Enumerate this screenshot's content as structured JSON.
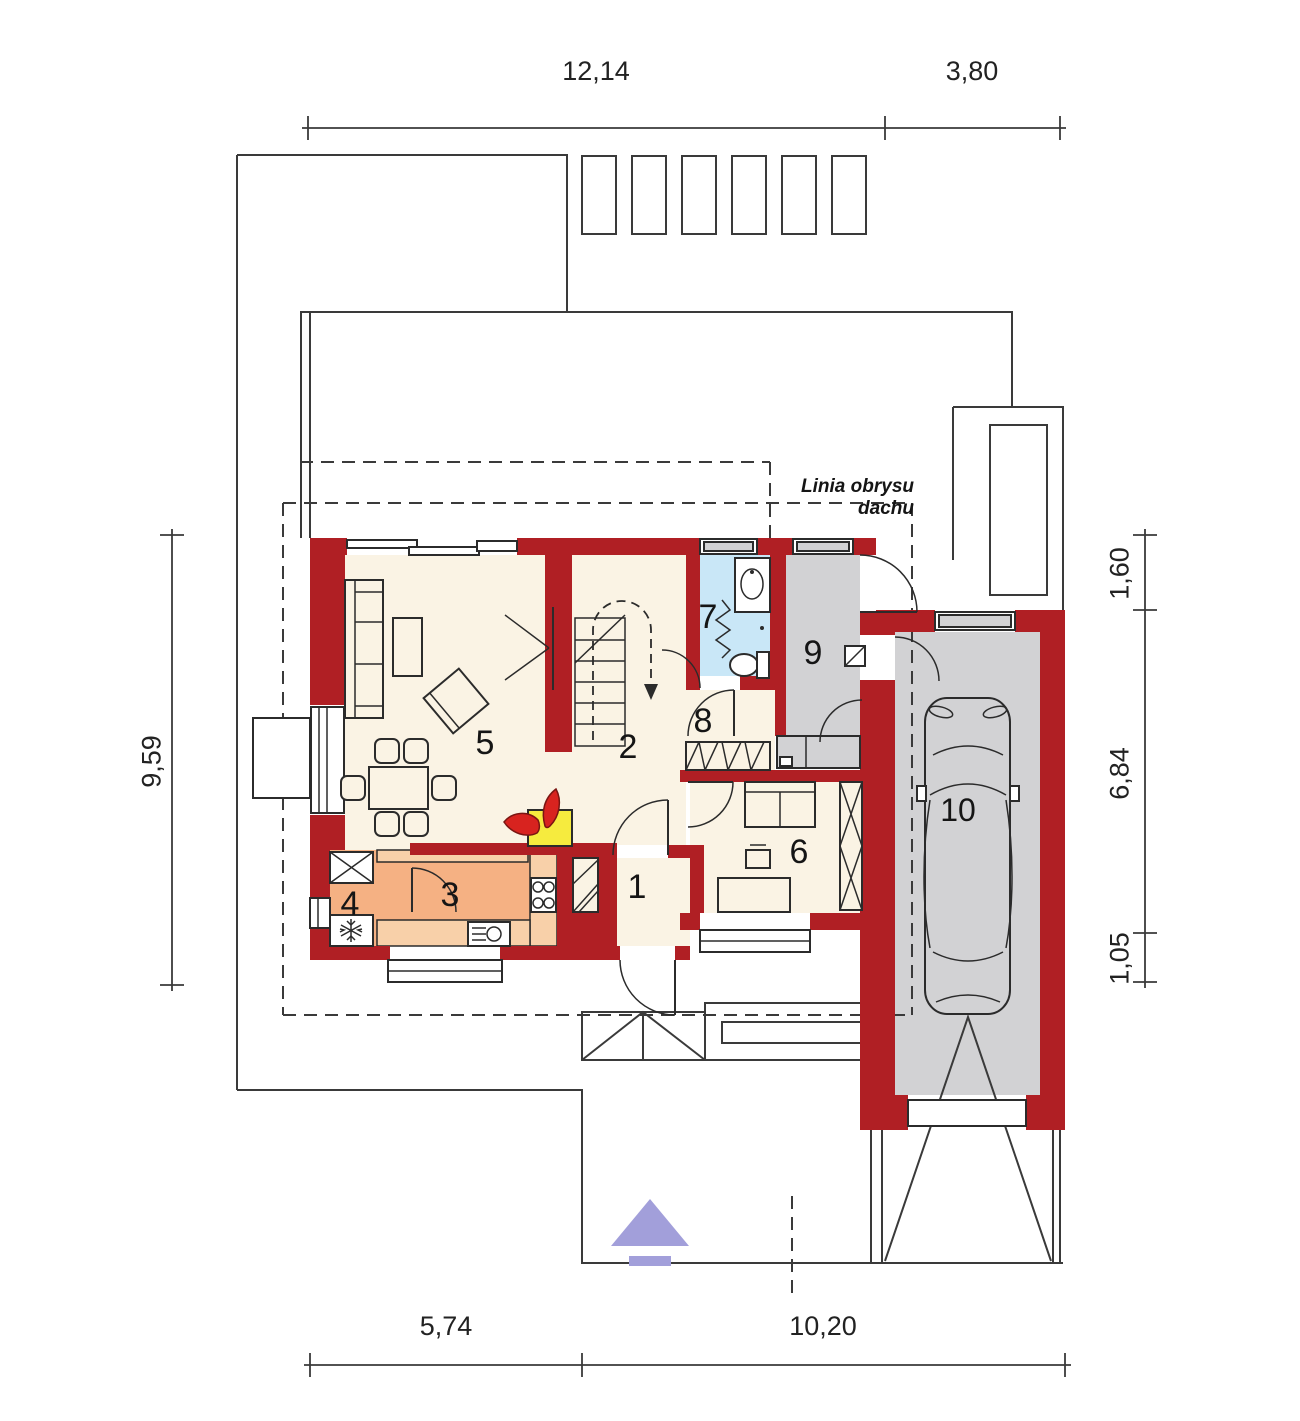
{
  "plan": {
    "roof_note": "Linia obrysu dachu",
    "rooms": {
      "r1": "1",
      "r2": "2",
      "r3": "3",
      "r4": "4",
      "r5": "5",
      "r6": "6",
      "r7": "7",
      "r8": "8",
      "r9": "9",
      "r10": "10"
    },
    "dimensions": {
      "top_left": "12,14",
      "top_right": "3,80",
      "bottom_left": "5,74",
      "bottom_right": "10,20",
      "left": "9,59",
      "right_top": "1,60",
      "right_middle": "6,84",
      "right_bottom": "1,05"
    },
    "colors": {
      "wall": "#b01f24",
      "floor": "#faf3e4",
      "kitchen": "#f5b183",
      "counter": "#f8d0a9",
      "bath": "#c9e7f7",
      "gray": "#d2d2d4",
      "fireplace_yellow": "#f6eb3e",
      "flame_red": "#d8231f",
      "arrow_purple": "#a29fda",
      "line": "#3a3a3a"
    }
  }
}
